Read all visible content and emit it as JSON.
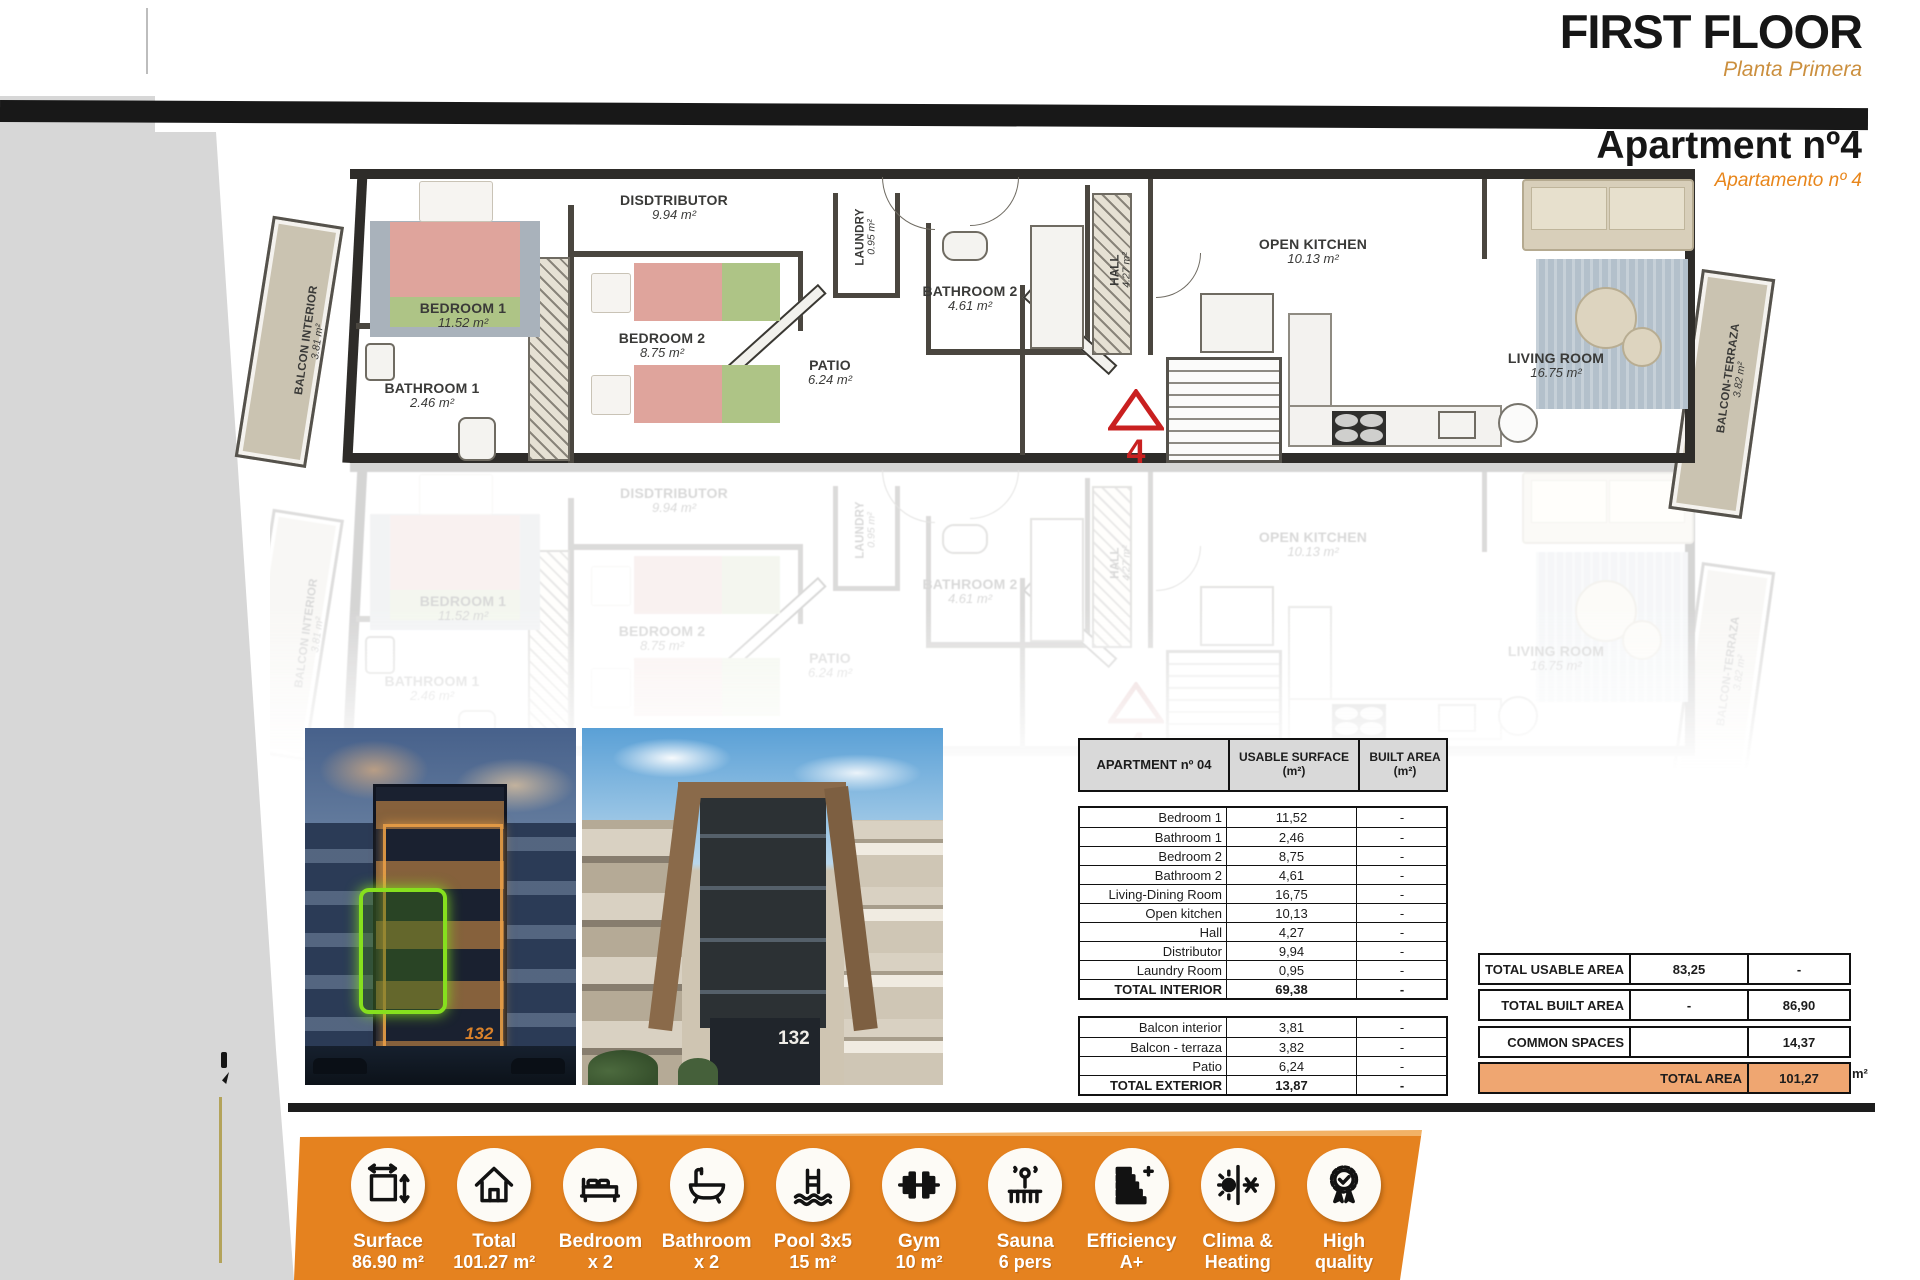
{
  "header": {
    "title": "FIRST FLOOR",
    "subtitle": "Planta Primera",
    "apartment_title": "Apartment nº4",
    "apartment_subtitle": "Apartamento nº 4"
  },
  "colors": {
    "accent_orange": "#E5821F",
    "subtitle_tan": "#CB8F3E",
    "table_header_bg": "#D9D9D9",
    "total_row_bg": "#EFA671",
    "plan_floor": "#CFC9B8",
    "wall": "#2E2C29",
    "marker_red": "#C92020",
    "highlight_green": "#86E01E"
  },
  "floor_plan": {
    "unit_marker": "4",
    "rooms": [
      {
        "name": "BEDROOM 1",
        "area": "11.52 m²",
        "x": 193,
        "y": 150,
        "rot": 0,
        "small": false
      },
      {
        "name": "BATHROOM 1",
        "area": "2.46 m²",
        "x": 162,
        "y": 230,
        "rot": 0,
        "small": false
      },
      {
        "name": "BEDROOM 2",
        "area": "8.75 m²",
        "x": 392,
        "y": 180,
        "rot": 0,
        "small": false
      },
      {
        "name": "DISDTRIBUTOR",
        "area": "9.94 m²",
        "x": 404,
        "y": 42,
        "rot": 0,
        "small": false
      },
      {
        "name": "LAUNDRY",
        "area": "0.95 m²",
        "x": 596,
        "y": 72,
        "rot": -90,
        "small": true
      },
      {
        "name": "PATIO",
        "area": "6.24 m²",
        "x": 560,
        "y": 207,
        "rot": 0,
        "small": false
      },
      {
        "name": "BATHROOM 2",
        "area": "4.61 m²",
        "x": 700,
        "y": 133,
        "rot": 0,
        "small": false
      },
      {
        "name": "HALL",
        "area": "4.27 m²",
        "x": 851,
        "y": 105,
        "rot": -90,
        "small": true
      },
      {
        "name": "OPEN KITCHEN",
        "area": "10.13 m²",
        "x": 1043,
        "y": 86,
        "rot": 0,
        "small": false
      },
      {
        "name": "LIVING ROOM",
        "area": "16.75 m²",
        "x": 1286,
        "y": 200,
        "rot": 0,
        "small": false
      },
      {
        "name": "BALCON INTERIOR",
        "area": "3.81 m²",
        "x": 42,
        "y": 176,
        "rot": -82,
        "small": true
      },
      {
        "name": "BALCON-TERRAZA",
        "area": "3.82 m²",
        "x": 1464,
        "y": 214,
        "rot": -82,
        "small": true
      }
    ]
  },
  "photos": [
    {
      "name": "night-render",
      "sign": "132"
    },
    {
      "name": "day-render",
      "sign": "132"
    }
  ],
  "area_table": {
    "header": [
      "APARTMENT nº 04",
      "USABLE SURFACE\n(m²)",
      "BUILT AREA\n(m²)"
    ],
    "interior_rows": [
      {
        "label": "Bedroom 1",
        "usable": "11,52",
        "built": "-",
        "total": false
      },
      {
        "label": "Bathroom 1",
        "usable": "2,46",
        "built": "-",
        "total": false
      },
      {
        "label": "Bedroom 2",
        "usable": "8,75",
        "built": "-",
        "total": false
      },
      {
        "label": "Bathroom 2",
        "usable": "4,61",
        "built": "-",
        "total": false
      },
      {
        "label": "Living-Dining Room",
        "usable": "16,75",
        "built": "-",
        "total": false
      },
      {
        "label": "Open kitchen",
        "usable": "10,13",
        "built": "-",
        "total": false
      },
      {
        "label": "Hall",
        "usable": "4,27",
        "built": "-",
        "total": false
      },
      {
        "label": "Distributor",
        "usable": "9,94",
        "built": "-",
        "total": false
      },
      {
        "label": "Laundry Room",
        "usable": "0,95",
        "built": "-",
        "total": false
      },
      {
        "label": "TOTAL INTERIOR",
        "usable": "69,38",
        "built": "-",
        "total": true
      }
    ],
    "exterior_rows": [
      {
        "label": "Balcon interior",
        "usable": "3,81",
        "built": "-",
        "total": false
      },
      {
        "label": "Balcon - terraza",
        "usable": "3,82",
        "built": "-",
        "total": false
      },
      {
        "label": "Patio",
        "usable": "6,24",
        "built": "-",
        "total": false
      },
      {
        "label": "TOTAL EXTERIOR",
        "usable": "13,87",
        "built": "-",
        "total": true
      }
    ]
  },
  "summary": {
    "rows": [
      {
        "label": "TOTAL USABLE AREA",
        "col2": "83,25",
        "col3": "-",
        "top": 953
      },
      {
        "label": "TOTAL BUILT AREA",
        "col2": "-",
        "col3": "86,90",
        "top": 989
      },
      {
        "label": "COMMON SPACES",
        "col2": "",
        "col3": "14,37",
        "top": 1026
      }
    ],
    "total": {
      "label": "TOTAL AREA",
      "value": "101,27",
      "unit": "m²",
      "top": 1062
    }
  },
  "features": [
    {
      "icon": "surface-icon",
      "line1": "Surface",
      "line2": "86.90 m²"
    },
    {
      "icon": "house-icon",
      "line1": "Total",
      "line2": "101.27 m²"
    },
    {
      "icon": "bed-icon",
      "line1": "Bedroom",
      "line2": "x 2"
    },
    {
      "icon": "bath-icon",
      "line1": "Bathroom",
      "line2": "x 2"
    },
    {
      "icon": "pool-icon",
      "line1": "Pool 3x5",
      "line2": "15 m²"
    },
    {
      "icon": "gym-icon",
      "line1": "Gym",
      "line2": "10 m²"
    },
    {
      "icon": "sauna-icon",
      "line1": "Sauna",
      "line2": "6 pers"
    },
    {
      "icon": "efficiency-icon",
      "line1": "Efficiency",
      "line2": "A+"
    },
    {
      "icon": "clima-icon",
      "line1": "Clima &",
      "line2": "Heating"
    },
    {
      "icon": "quality-icon",
      "line1": "High",
      "line2": "quality"
    }
  ]
}
